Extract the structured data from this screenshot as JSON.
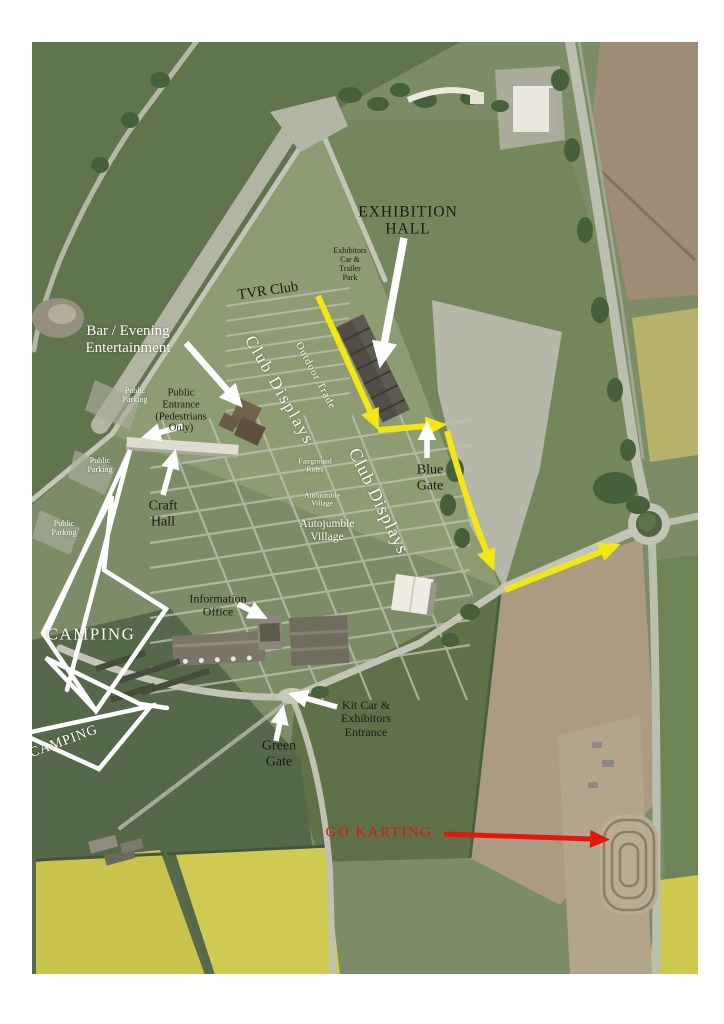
{
  "map": {
    "description_labels_count": 23,
    "colors": {
      "route_arrow_yellow": "#f3e713",
      "route_arrow_red": "#e3170d",
      "annotation_arrow_white": "#ffffff",
      "camping_outline_white": "#ffffff",
      "label_black": "#1b1b16",
      "label_white": "#fbfbf4",
      "go_karting_red": "#e3170d"
    }
  },
  "labels": {
    "exhibition_hall": "EXHIBITION\nHALL",
    "exhibitors_car_trailer_park": "Exhibitors\nCar &\nTrailer\nPark",
    "tvr_club": "TVR Club",
    "bar_evening_entertainment": "Bar / Evening\nEntertainment",
    "club_displays_upper": "Club Displays",
    "outdoor_trade": "Outdoor Trade",
    "public_parking_entrance": "Public\nParking",
    "public_entrance_pedestrians": "Public\nEntrance\n(Pedestrians\nOnly)",
    "public_parking_west": "Public\nParking",
    "craft_hall": "Craft\nHall",
    "public_parking_south": "Public\nParking",
    "public_parking_edge": "Public\nParking",
    "camping_main": "CAMPING",
    "camping_secondary": "CAMPING",
    "fairground_rides": "Fairground\nRides",
    "autojumble_village_small": "Autojumble\nVillage",
    "autojumble_village_large": "Autojumble\nVillage",
    "club_displays_lower": "Club Displays",
    "blue_gate": "Blue\nGate",
    "information_office": "Information\nOffice",
    "kit_car_exhibitors_entrance": "Kit Car &\nExhibitors\nEntrance",
    "green_gate": "Green\nGate",
    "go_karting": "GO KARTING"
  }
}
